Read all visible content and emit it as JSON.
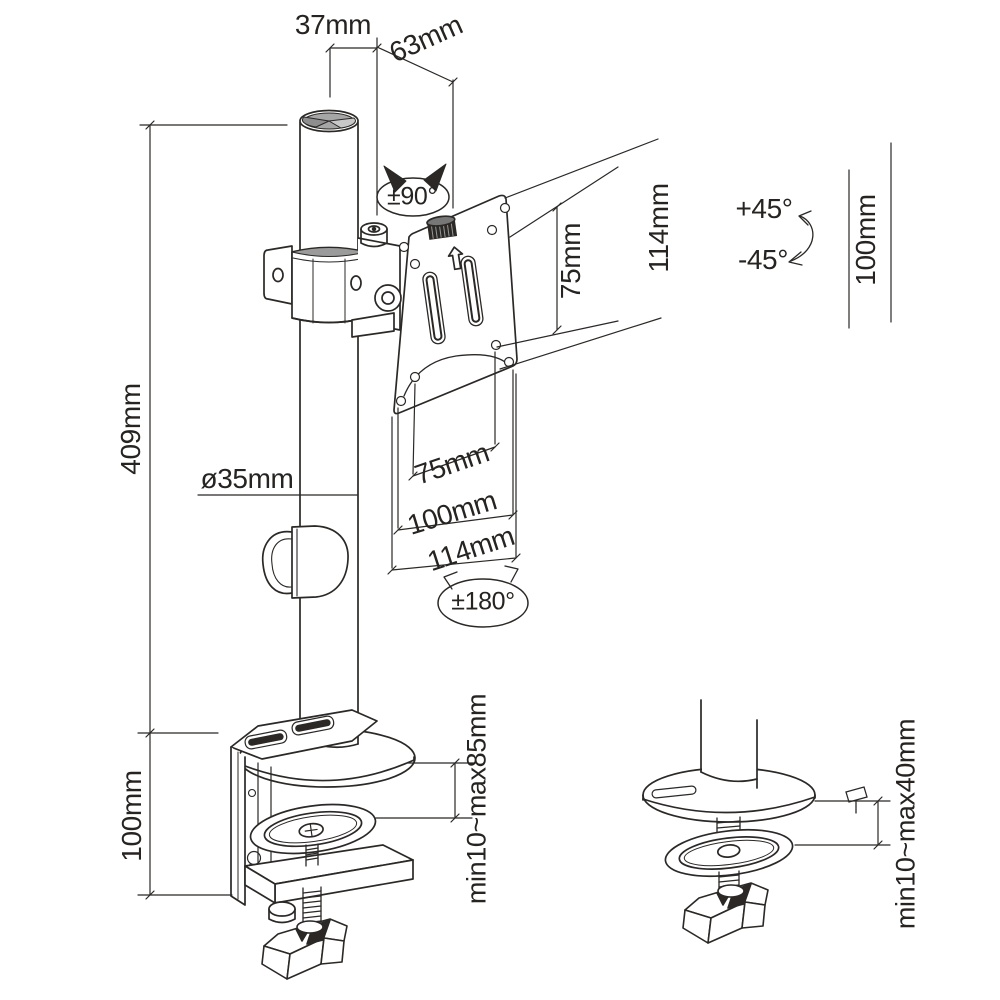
{
  "title": "monitor-mount-dimension-drawing",
  "colors": {
    "line": "#2b2826",
    "background": "#ffffff",
    "cap_gray": "#a6a6a6"
  },
  "dimensions": {
    "top_offset": "37mm",
    "arm_offset": "63mm",
    "vesa_hole_spacing_right": "75mm",
    "plate_height_right": "114mm",
    "height_range_right": "100mm",
    "pole_length": "409mm",
    "pole_diameter": "ø35mm",
    "vesa_width_75": "75mm",
    "vesa_width_100": "100mm",
    "plate_width_114": "114mm",
    "clamp_section_height": "100mm",
    "clamp_thickness_range": "min10~max85mm",
    "grommet_thickness_range": "min10~max40mm"
  },
  "angles": {
    "tilt_range": "±90°",
    "swivel_up": "+45°",
    "swivel_down": "-45°",
    "rotation_range": "±180°"
  }
}
